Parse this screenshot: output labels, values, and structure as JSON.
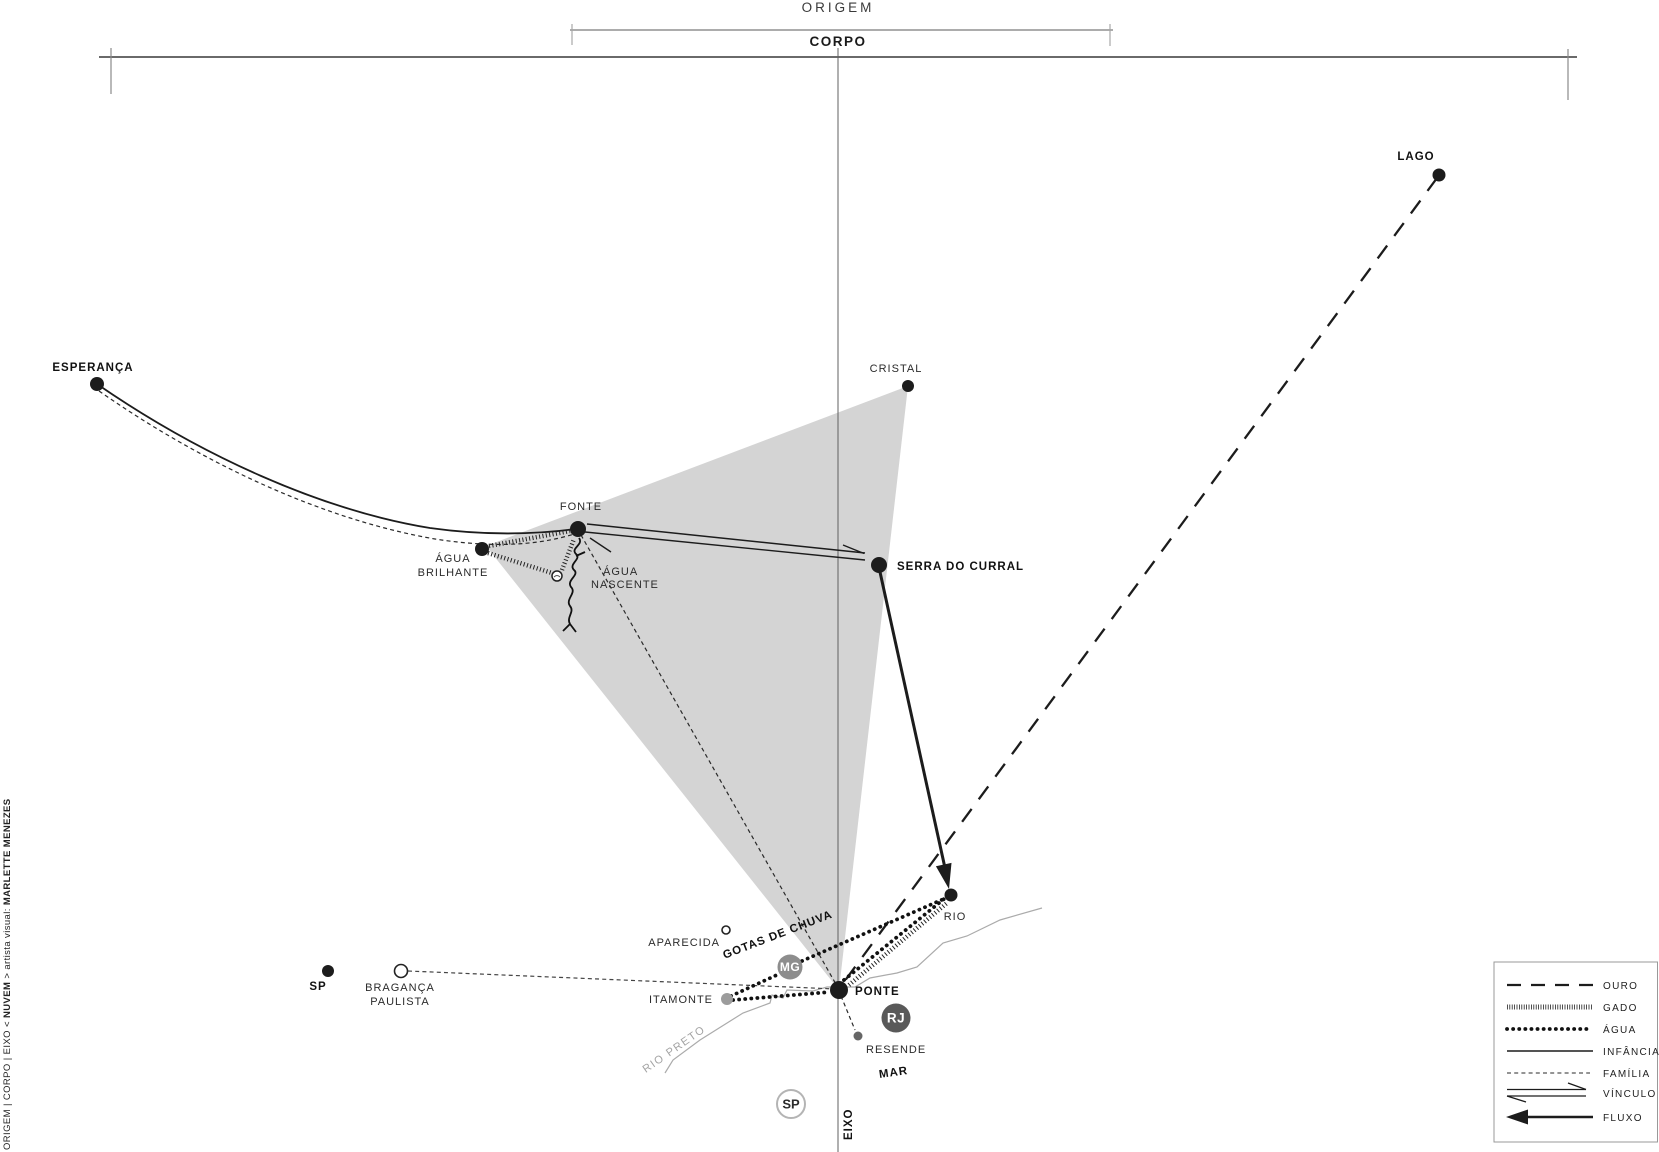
{
  "header": {
    "origem": "ORIGEM",
    "corpo": "CORPO"
  },
  "axis_label": "EIXO",
  "nodes": {
    "esperanca": {
      "label": "ESPERANÇA"
    },
    "lago": {
      "label": "LAGO"
    },
    "cristal": {
      "label": "CRISTAL"
    },
    "fonte": {
      "label": "FONTE"
    },
    "agua_brilhante": {
      "line1": "ÁGUA",
      "line2": "BRILHANTE"
    },
    "agua_nascente": {
      "line1": "ÁGUA",
      "line2": "NASCENTE"
    },
    "serra_do_curral": {
      "label": "SERRA DO CURRAL"
    },
    "rio": {
      "label": "RIO"
    },
    "ponte": {
      "label": "PONTE"
    },
    "itamonte": {
      "label": "ITAMONTE"
    },
    "aparecida": {
      "label": "APARECIDA"
    },
    "braganca_paulista": {
      "line1": "BRAGANÇA",
      "line2": "PAULISTA"
    },
    "sp_dot": {
      "label": "SP"
    },
    "resende": {
      "label": "RESENDE"
    }
  },
  "badges": {
    "mg": "MG",
    "rj": "RJ",
    "sp": "SP"
  },
  "annotations": {
    "gotas_de_chuva": "GOTAS DE CHUVA",
    "rio_preto": "RIO PRETO",
    "mar": "MAR"
  },
  "legend": {
    "items": [
      {
        "style": "ouro",
        "label": "OURO"
      },
      {
        "style": "gado",
        "label": "GADO"
      },
      {
        "style": "agua",
        "label": "ÁGUA"
      },
      {
        "style": "infancia",
        "label": "INFÂNCIA"
      },
      {
        "style": "familia",
        "label": "FAMÍLIA"
      },
      {
        "style": "vinculo",
        "label": "VÍNCULO"
      },
      {
        "style": "fluxo",
        "label": "FLUXO"
      }
    ]
  },
  "credit": {
    "prefix": "ORIGEM | CORPO | EIXO < ",
    "highlight": "NUVEM",
    "middle": " > artista visual: ",
    "author": "MARLETTE MENEZES"
  },
  "colors": {
    "shade": "#d4d4d4",
    "ink": "#1c1c1c",
    "badge_mg": "#8d8d8d",
    "badge_rj": "#595959",
    "badge_sp_stroke": "#b4b4b4",
    "badge_sp_text": "#9e9e9e",
    "river": "#ababab"
  }
}
